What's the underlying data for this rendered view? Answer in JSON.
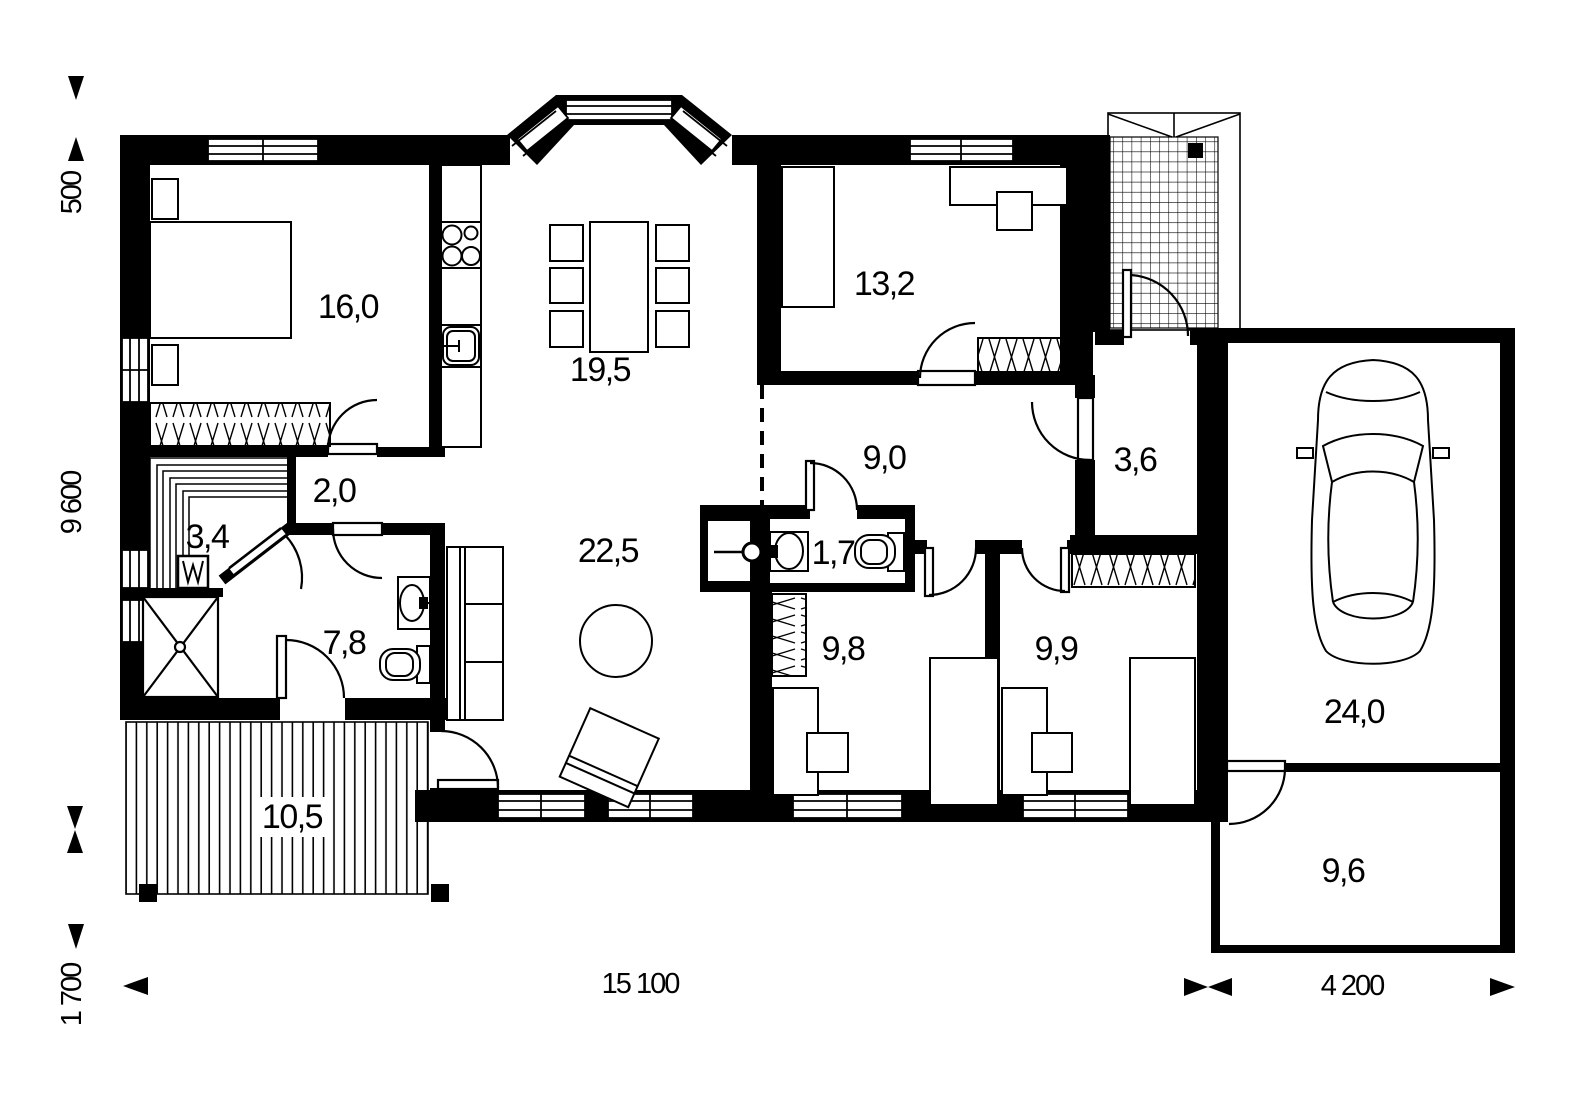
{
  "rooms": {
    "bedroom_master": "16,0",
    "dining_kitchen": "19,5",
    "bedroom_top_right": "13,2",
    "hall_small": "2,0",
    "sauna": "3,4",
    "bathroom": "7,8",
    "living": "22,5",
    "hallway": "9,0",
    "wc": "1,7",
    "vestibule": "3,6",
    "bedroom_bottom_left": "9,8",
    "bedroom_bottom_right": "9,9",
    "terrace": "10,5",
    "garage": "24,0",
    "storage": "9,6"
  },
  "dimensions": {
    "overhang": "500",
    "house_depth": "9 600",
    "terrace_depth": "1 700",
    "house_width": "15 100",
    "garage_width": "4 200"
  }
}
